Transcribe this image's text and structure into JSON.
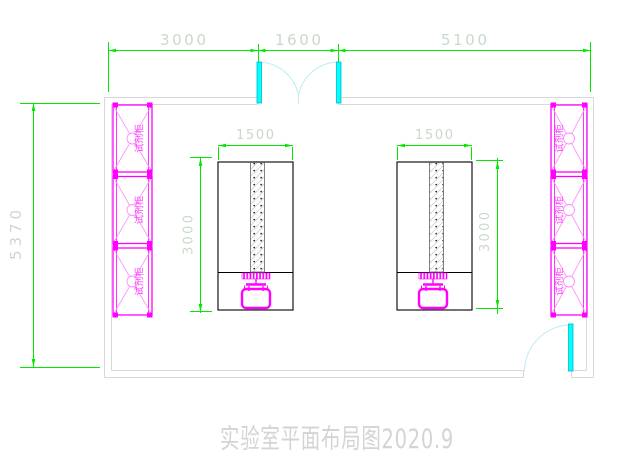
{
  "title": "实验室平面布局图2020.9",
  "dimensions": {
    "top_segments": [
      "3000",
      "1600",
      "5100"
    ],
    "overall_height": "5370"
  },
  "benches": [
    {
      "width_label": "1500",
      "depth_label": "3000"
    },
    {
      "width_label": "1500",
      "depth_label": "3000"
    }
  ],
  "cabinets": {
    "left": [
      {
        "label": "试剂柜"
      },
      {
        "label": "试剂柜"
      },
      {
        "label": "试剂柜"
      }
    ],
    "right": [
      {
        "label": "试剂柜"
      },
      {
        "label": "试剂柜"
      },
      {
        "label": "试剂柜"
      }
    ]
  },
  "colors": {
    "dimension_line": "#00e800",
    "dimension_text": "#c9d9c9",
    "wall_line": "#d8d8d8",
    "cabinet_magenta": "#ff00ff",
    "bench_outline": "#000000",
    "door_leaf_cyan": "#00ffff",
    "door_arc": "#bdecf3",
    "title_text": "#d4d4d4"
  }
}
